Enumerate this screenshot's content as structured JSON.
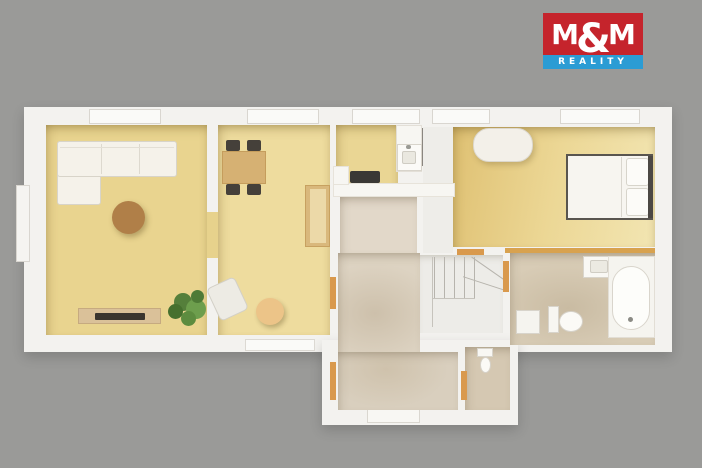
{
  "logo": {
    "m1": "M",
    "amp": "&",
    "m2": "M",
    "reality": "REALITY",
    "red": "#c5242c",
    "blue": "#2b9cd4"
  },
  "palette": {
    "background_gray": "#9a9a98",
    "plan_white": "#f3f2ef",
    "wood_floor": "#e9d48f",
    "tile_floor": "#d8ccb6",
    "door_threshold_wood": "#d9994d"
  },
  "shapes": [
    {
      "n": "plan-body",
      "x": 24,
      "y": 107,
      "w": 648,
      "h": 245,
      "bg": "#f3f2ef",
      "sh": "0 5px 12px rgba(0,0,0,0.16)"
    },
    {
      "n": "plan-extension-hall",
      "x": 322,
      "y": 340,
      "w": 196,
      "h": 85,
      "bg": "#f3f2ef",
      "sh": "0 5px 12px rgba(0,0,0,0.16)"
    },
    {
      "n": "window-top-living",
      "x": 89,
      "y": 109,
      "w": 72,
      "h": 15,
      "bg": "#fafaf8",
      "br": "1px solid #d9d6d0"
    },
    {
      "n": "window-top-dining",
      "x": 247,
      "y": 109,
      "w": 72,
      "h": 15,
      "bg": "#fafaf8",
      "br": "1px solid #d9d6d0"
    },
    {
      "n": "window-top-kitchen",
      "x": 352,
      "y": 109,
      "w": 68,
      "h": 15,
      "bg": "#fafaf8",
      "br": "1px solid #d9d6d0"
    },
    {
      "n": "window-top-corridor",
      "x": 432,
      "y": 109,
      "w": 58,
      "h": 15,
      "bg": "#fafaf8",
      "br": "1px solid #d9d6d0"
    },
    {
      "n": "window-top-bedroom",
      "x": 560,
      "y": 109,
      "w": 80,
      "h": 15,
      "bg": "#fafaf8",
      "br": "1px solid #d9d6d0"
    },
    {
      "n": "window-left-living",
      "x": 16,
      "y": 185,
      "w": 14,
      "h": 77,
      "bg": "#f5f4f1",
      "br": "1px solid #d9d6d0"
    },
    {
      "n": "window-bottom-dining",
      "x": 245,
      "y": 339,
      "w": 70,
      "h": 12,
      "bg": "#fafaf8",
      "br": "1px solid #dcd9d3"
    },
    {
      "n": "entry-door",
      "x": 367,
      "y": 409,
      "w": 53,
      "h": 14,
      "bg": "#f8f7f3",
      "br": "1px solid #dad7d0"
    },
    {
      "n": "living-room-floor",
      "x": 46,
      "y": 125,
      "w": 161,
      "h": 210,
      "bg": "#e9d48f",
      "cls": "wood rshadow"
    },
    {
      "n": "dining-room-floor",
      "x": 218,
      "y": 125,
      "w": 112,
      "h": 210,
      "bg": "#eedc9e",
      "cls": "wood rshadow"
    },
    {
      "n": "doorway-living-dining",
      "x": 207,
      "y": 212,
      "w": 11,
      "h": 46,
      "bg": "#e7d28c",
      "cls": "wood"
    },
    {
      "n": "kitchen-floor",
      "x": 336,
      "y": 125,
      "w": 62,
      "h": 72,
      "bg": "#ead694",
      "cls": "wood rshadow"
    },
    {
      "n": "corridor-floor",
      "x": 423,
      "y": 127,
      "w": 30,
      "h": 126,
      "bg": "#eeede9"
    },
    {
      "n": "bedroom-floor",
      "x": 453,
      "y": 127,
      "w": 202,
      "h": 120,
      "bg": "linear-gradient(100deg,#dfc173,#ecd795 50%,#f2e5b2)",
      "cls": "wood rshadow"
    },
    {
      "n": "hall-upper-floor",
      "x": 340,
      "y": 197,
      "w": 77,
      "h": 56,
      "bg": "#e2d8c9",
      "cls": "tile"
    },
    {
      "n": "hall-main-floor",
      "x": 338,
      "y": 253,
      "w": 82,
      "h": 110,
      "bg": "radial-gradient(90px 70px at 45% 55%,#cdc0ab,#ddd3c2 72%)",
      "cls": "tile"
    },
    {
      "n": "hall-lower-floor",
      "x": 338,
      "y": 352,
      "w": 120,
      "h": 58,
      "bg": "radial-gradient(80px 50px at 40% 30%,#cfc2ac,#d9cfbe 78%)",
      "cls": "tile"
    },
    {
      "n": "stairs-area",
      "x": 420,
      "y": 255,
      "w": 83,
      "h": 78,
      "bg": "#edece8",
      "sh": "inset 0 6px 8px -5px rgba(90,75,50,0.3)"
    },
    {
      "n": "bathroom-floor",
      "x": 510,
      "y": 253,
      "w": 145,
      "h": 92,
      "bg": "radial-gradient(100px 60px at 40% 60%,#c9bba2,#d8ccb6 78%)",
      "cls": "tile"
    },
    {
      "n": "wc-floor",
      "x": 465,
      "y": 347,
      "w": 45,
      "h": 63,
      "bg": "#d5c8b2",
      "cls": "tile"
    },
    {
      "n": "stair-riser-1",
      "x": 434,
      "y": 257,
      "w": 1,
      "h": 42,
      "bg": "#b7b4ad"
    },
    {
      "n": "stair-riser-2",
      "x": 444,
      "y": 257,
      "w": 1,
      "h": 42,
      "bg": "#b7b4ad"
    },
    {
      "n": "stair-riser-3",
      "x": 454,
      "y": 257,
      "w": 1,
      "h": 42,
      "bg": "#b7b4ad"
    },
    {
      "n": "stair-riser-4",
      "x": 464,
      "y": 257,
      "w": 1,
      "h": 42,
      "bg": "#b7b4ad"
    },
    {
      "n": "stair-riser-5",
      "x": 474,
      "y": 257,
      "w": 1,
      "h": 42,
      "bg": "#b7b4ad"
    },
    {
      "n": "stair-winder-tread-1",
      "x": 468,
      "y": 268,
      "w": 40,
      "h": 1,
      "bg": "#b7b4ad",
      "rot": 35
    },
    {
      "n": "stair-winder-tread-2",
      "x": 462,
      "y": 283,
      "w": 44,
      "h": 1,
      "bg": "#b7b4ad",
      "rot": 18
    },
    {
      "n": "stair-landing-edge",
      "x": 432,
      "y": 257,
      "w": 1,
      "h": 70,
      "bg": "#c6c3bc"
    },
    {
      "n": "stair-bottom-edge",
      "x": 433,
      "y": 298,
      "w": 42,
      "h": 1,
      "bg": "#c6c3bc"
    },
    {
      "n": "door-threshold-hall",
      "x": 330,
      "y": 277,
      "w": 6,
      "h": 32,
      "bg": "#d9994d"
    },
    {
      "n": "door-threshold-entry-side",
      "x": 330,
      "y": 362,
      "w": 6,
      "h": 38,
      "bg": "#d9994d"
    },
    {
      "n": "door-threshold-wc",
      "x": 461,
      "y": 371,
      "w": 6,
      "h": 29,
      "bg": "#d9994d"
    },
    {
      "n": "door-threshold-bathroom",
      "x": 503,
      "y": 261,
      "w": 6,
      "h": 31,
      "bg": "#d9994d"
    },
    {
      "n": "door-threshold-bedroom",
      "x": 457,
      "y": 249,
      "w": 27,
      "h": 6,
      "bg": "#d9994d"
    },
    {
      "n": "bathroom-wall-strip",
      "x": 505,
      "y": 248,
      "w": 150,
      "h": 5,
      "bg": "#d8a24f"
    },
    {
      "n": "bedroom-door-frame",
      "x": 421,
      "y": 128,
      "w": 2,
      "h": 38,
      "bg": "#8a8680"
    },
    {
      "n": "sofa-chaise",
      "x": 57,
      "y": 141,
      "w": 44,
      "h": 64,
      "bg": "#f5f2ea",
      "br": "1px solid #d8d4c9",
      "r": "3px"
    },
    {
      "n": "sofa-body",
      "x": 57,
      "y": 141,
      "w": 120,
      "h": 36,
      "bg": "#f5f2ea",
      "br": "1px solid #d8d4c9",
      "r": "3px"
    },
    {
      "n": "sofa-cushion-line-1",
      "x": 101,
      "y": 144,
      "w": 1,
      "h": 30,
      "bg": "#ddd9cf"
    },
    {
      "n": "sofa-cushion-line-2",
      "x": 139,
      "y": 144,
      "w": 1,
      "h": 30,
      "bg": "#ddd9cf"
    },
    {
      "n": "sofa-back-line",
      "x": 60,
      "y": 147,
      "w": 114,
      "h": 1,
      "bg": "#e3dfd5"
    },
    {
      "n": "coffee-table",
      "x": 112,
      "y": 201,
      "w": 33,
      "h": 33,
      "bg": "#b07f48",
      "cls": "slat",
      "r": "50%",
      "sh": "2px 3px 6px rgba(80,60,20,0.35)"
    },
    {
      "n": "tv-stand",
      "x": 78,
      "y": 308,
      "w": 83,
      "h": 16,
      "bg": "#dac199",
      "br": "1px solid #c6aa80"
    },
    {
      "n": "tv",
      "x": 95,
      "y": 313,
      "w": 50,
      "h": 7,
      "bg": "#3a352f",
      "r": "1px"
    },
    {
      "n": "plant-leaf-1",
      "x": 174,
      "y": 293,
      "w": 18,
      "h": 18,
      "bg": "#557f3b",
      "r": "50%"
    },
    {
      "n": "plant-leaf-2",
      "x": 186,
      "y": 299,
      "w": 20,
      "h": 20,
      "bg": "#6d9e4d",
      "r": "50%"
    },
    {
      "n": "plant-leaf-3",
      "x": 168,
      "y": 304,
      "w": 15,
      "h": 15,
      "bg": "#46702e",
      "r": "50%"
    },
    {
      "n": "plant-leaf-4",
      "x": 181,
      "y": 311,
      "w": 15,
      "h": 15,
      "bg": "#5d8c3f",
      "r": "50%"
    },
    {
      "n": "plant-leaf-5",
      "x": 191,
      "y": 290,
      "w": 13,
      "h": 13,
      "bg": "#4e7a36",
      "r": "50%"
    },
    {
      "n": "dining-chair-1",
      "x": 226,
      "y": 140,
      "w": 14,
      "h": 11,
      "bg": "#45403a",
      "r": "2px"
    },
    {
      "n": "dining-chair-2",
      "x": 247,
      "y": 140,
      "w": 14,
      "h": 11,
      "bg": "#45403a",
      "r": "2px"
    },
    {
      "n": "dining-chair-3",
      "x": 226,
      "y": 184,
      "w": 14,
      "h": 11,
      "bg": "#45403a",
      "r": "2px"
    },
    {
      "n": "dining-chair-4",
      "x": 247,
      "y": 184,
      "w": 14,
      "h": 11,
      "bg": "#45403a",
      "r": "2px"
    },
    {
      "n": "dining-table",
      "x": 222,
      "y": 151,
      "w": 44,
      "h": 33,
      "bg": "#d6b173",
      "br": "1px solid #c59d5c"
    },
    {
      "n": "desk-chair",
      "x": 212,
      "y": 281,
      "w": 31,
      "h": 36,
      "bg": "#edebe4",
      "br": "1px solid #d3d0c7",
      "r": "5px",
      "rot": -25
    },
    {
      "n": "pouf",
      "x": 256,
      "y": 298,
      "w": 28,
      "h": 27,
      "bg": "#ecc488",
      "r": "50%",
      "sh": "2px 3px 5px rgba(80,60,20,0.3)"
    },
    {
      "n": "dining-cabinet",
      "x": 305,
      "y": 185,
      "w": 25,
      "h": 62,
      "bg": "#d9b87c",
      "br": "1px solid #c7a160"
    },
    {
      "n": "dining-cabinet-front",
      "x": 310,
      "y": 189,
      "w": 16,
      "h": 54,
      "bg": "#ecd9a8"
    },
    {
      "n": "kitchen-cabinet-run",
      "x": 396,
      "y": 125,
      "w": 26,
      "h": 47,
      "bg": "#f7f6f2",
      "br": "1px solid #e3dfd7"
    },
    {
      "n": "kitchen-sink-unit",
      "x": 397,
      "y": 144,
      "w": 25,
      "h": 27,
      "bg": "#fbfaf7",
      "br": "1px solid #d8d4cb"
    },
    {
      "n": "kitchen-sink-basin",
      "x": 402,
      "y": 151,
      "w": 14,
      "h": 13,
      "bg": "#eae8e0",
      "br": "1px solid #cfccc3",
      "r": "2px"
    },
    {
      "n": "kitchen-faucet",
      "x": 406,
      "y": 145,
      "w": 5,
      "h": 4,
      "bg": "#9a9a94",
      "r": "2px"
    },
    {
      "n": "kitchen-counter",
      "x": 333,
      "y": 183,
      "w": 122,
      "h": 14,
      "bg": "#f7f6f2",
      "br": "1px solid #e7e3da"
    },
    {
      "n": "kitchen-counter-l",
      "x": 333,
      "y": 166,
      "w": 16,
      "h": 19,
      "bg": "#f7f6f2",
      "br": "1px solid #e7e3da"
    },
    {
      "n": "cooktop",
      "x": 350,
      "y": 171,
      "w": 30,
      "h": 12,
      "bg": "#3a3835",
      "r": "2px"
    },
    {
      "n": "bedroom-bench",
      "x": 473,
      "y": 128,
      "w": 60,
      "h": 34,
      "bg": "#f3f0e9",
      "br": "1px solid #dcd8ce",
      "r": "16px",
      "sh": "2px 3px 6px rgba(90,70,30,0.25)"
    },
    {
      "n": "bed",
      "x": 566,
      "y": 154,
      "w": 87,
      "h": 66,
      "bg": "#f7f5f0",
      "br": "2px solid #59554f"
    },
    {
      "n": "bed-fold-line",
      "x": 621,
      "y": 157,
      "w": 1,
      "h": 60,
      "bg": "#d9d6ce"
    },
    {
      "n": "bed-pillow-1",
      "x": 626,
      "y": 158,
      "w": 23,
      "h": 28,
      "bg": "#fcfbf8",
      "br": "1px solid #d7d4cb",
      "r": "3px"
    },
    {
      "n": "bed-pillow-2",
      "x": 626,
      "y": 188,
      "w": 23,
      "h": 28,
      "bg": "#fcfbf8",
      "br": "1px solid #d7d4cb",
      "r": "3px"
    },
    {
      "n": "headboard",
      "x": 648,
      "y": 156,
      "w": 5,
      "h": 62,
      "bg": "#4c4844"
    },
    {
      "n": "bath-sink",
      "x": 583,
      "y": 256,
      "w": 33,
      "h": 22,
      "bg": "#f9f8f4",
      "br": "1px solid #d9d5cc"
    },
    {
      "n": "bath-sink-basin",
      "x": 590,
      "y": 260,
      "w": 18,
      "h": 13,
      "bg": "#eceae2",
      "br": "1px solid #d0cdc4",
      "r": "2px"
    },
    {
      "n": "bathtub-surround",
      "x": 608,
      "y": 256,
      "w": 47,
      "h": 82,
      "bg": "#f5f4ef",
      "br": "1px solid #e2ded5"
    },
    {
      "n": "bathtub",
      "x": 612,
      "y": 266,
      "w": 38,
      "h": 64,
      "bg": "#fdfdfa",
      "br": "1px solid #d9d5cc",
      "r": "19px"
    },
    {
      "n": "bathtub-drain",
      "x": 628,
      "y": 317,
      "w": 5,
      "h": 5,
      "bg": "#8b8b85",
      "r": "50%"
    },
    {
      "n": "bath-toilet-tank",
      "x": 548,
      "y": 306,
      "w": 11,
      "h": 27,
      "bg": "#f7f6f1",
      "br": "1px solid #d8d4cb"
    },
    {
      "n": "bath-toilet-bowl",
      "x": 559,
      "y": 311,
      "w": 24,
      "h": 21,
      "bg": "#fbfaf6",
      "br": "1px solid #d6d2c9",
      "r": "50%"
    },
    {
      "n": "washing-machine",
      "x": 516,
      "y": 310,
      "w": 24,
      "h": 24,
      "bg": "#f5f4ef",
      "br": "1px solid #d8d4cb"
    },
    {
      "n": "wc-toilet-tank",
      "x": 477,
      "y": 348,
      "w": 16,
      "h": 9,
      "bg": "#f8f7f3",
      "br": "1px solid #d8d4cb"
    },
    {
      "n": "wc-toilet-bowl",
      "x": 480,
      "y": 357,
      "w": 11,
      "h": 16,
      "bg": "#fbfaf6",
      "br": "1px solid #d6d2c9",
      "r": "50%"
    }
  ]
}
